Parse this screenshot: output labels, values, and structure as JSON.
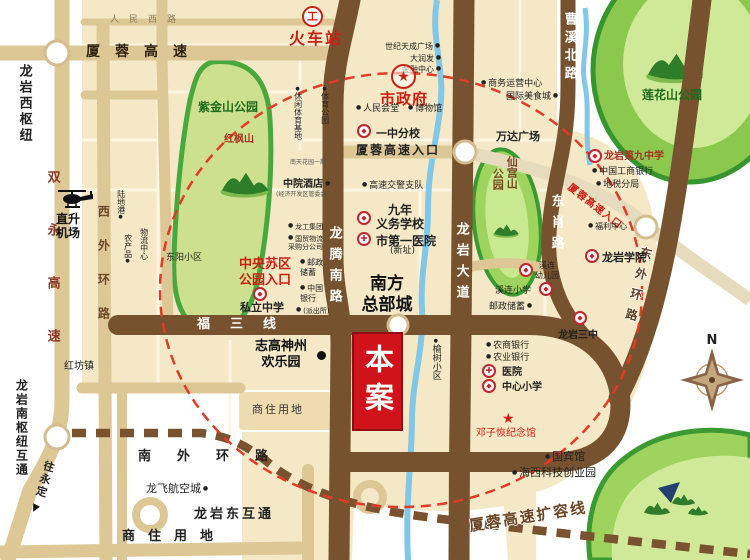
{
  "colors": {
    "accent_red": "#cc1f14",
    "road_brown": "#76522e",
    "road_tan": "#dcc795",
    "urban_beige": "#f5e8c6",
    "park_green": "#9ed45e",
    "park_border_green": "#3c9a33",
    "river_blue": "#82c8e6",
    "ring_dashed_red": "#e23b28"
  },
  "icons": {
    "school-icon": "◆ in red ring",
    "hospital-icon": "✚ in red ring",
    "government-icon": "★ in red ring",
    "train-station-icon": "工 in red ring",
    "memorial-star-icon": "★",
    "poi-dot-icon": "●",
    "helicopter-icon": "black helicopter silhouette",
    "compass-icon": "8-point rose",
    "direction-arrow-icon": "▼"
  },
  "compass": {
    "n": "N"
  },
  "labels": {
    "renmin_xi_lu": "人民西路",
    "xiarong_gaosu": "厦蓉高速",
    "longyan_xi_shuniu": "龙岩西枢纽",
    "shuangyong_gaosu": "双永高速",
    "xiwai_huanlu": "西外环路",
    "zhishengjichang": "直升\n机场",
    "ludigang": "陆地港",
    "wuliu_zhongxin": "物流中心",
    "nongchanpin": "农产品",
    "dongyang_xiaoqu": "东阳小区",
    "hongfang_zhen": "红坊镇",
    "zijinshan": "紫金山公园",
    "hongfengshan": "红枫山",
    "zhongyang_suqu": "中央苏区\n公园入口",
    "sili_zhongxue": "私立中学",
    "zhigao": "志高神州\n欢乐园",
    "shangzhu_block": "商住用地",
    "fusanxian": "福三线",
    "longteng_nanlu": "龙腾南路",
    "longyan_dadao": "龙岩大道",
    "caoxi_beilu": "曹溪北路",
    "dongxiao_lu": "东肖路",
    "dongwai_huanlu": "东外环路",
    "nanwai_huanlu": "南外环路",
    "longyan_dong_hutong": "龙岩东互通",
    "shangzhu_bottom": "商住用地",
    "longfei": "龙飞航空城",
    "wang_yongding": "往永定",
    "longyan_nan_shuniu": "龙岩南枢纽互通",
    "huochezhan": "火车站",
    "shiji_tiancheng": "世纪天成广场",
    "darunfa": "大润发",
    "jinrong_zhongxin": "金融中心",
    "shizhengfu": "市政府",
    "renmin_huitang": "人民会堂",
    "bowuguan": "博物馆",
    "yizhong_fenxiao": "一中分校",
    "xiarong_rukou": "厦蓉高速入口",
    "gaosu_jiaojing": "高速交警支队",
    "jiunian_yiwu": "九年\n义务学校",
    "shidiyi_yiyuan": "市第一医院",
    "xinzhi": "(新址)",
    "nanfang_zongbu": "南方\n总部城",
    "zhongyuan_jiudian": "中院酒店",
    "jingkaiqu": "(经济开发区管委会)",
    "nantian": "南天花园一期",
    "longgong_jituan": "龙工集团",
    "guomao_wuliu": "国贸物流\n采购分公司",
    "youzheng_w": "邮政\n储蓄",
    "zhongguo_yinhang": "中国\n银行",
    "paichusuo": "(派出所)",
    "tiyu_gongyuan": "体育公园",
    "xiuxian_jidi": "休闲体育基地",
    "ben_an": "本案",
    "yushu_xiaoqu": "榆树小区",
    "wanda": "万达广场",
    "shangwu_yunying": "商务运营中心",
    "guoji_meishi": "国际美食城",
    "lianhuashan": "莲花山公园",
    "dijiu_zhongxue": "龙岩第九中学",
    "gongshang_yinhang": "中国工商银行",
    "dishui_fenju": "地税分局",
    "xiarong_rukou_diag": "厦蓉高速入口",
    "fuli_zhongxin": "福利中心",
    "longyan_xueyuan": "龙岩学院",
    "xiangong_shan": "仙宫山",
    "xiangong_gongyuan": "公园",
    "xilian_youeryuan": "溪连\n幼儿园",
    "xilian_xiaoxue": "溪连小学",
    "youzheng_e": "邮政储蓄",
    "longyan_sanzhong": "龙岩三中",
    "nongshang_yinhang": "农商银行",
    "nongye_yinhang": "农业银行",
    "yiyuan": "医院",
    "zhongxin_xiaoxue": "中心小学",
    "dengzihui": "邓子恢纪念馆",
    "guobinguan": "国宾馆",
    "haixi_chuangye": "海西科技创业园",
    "xiarong_kuorong": "厦蓉高速扩容线"
  }
}
